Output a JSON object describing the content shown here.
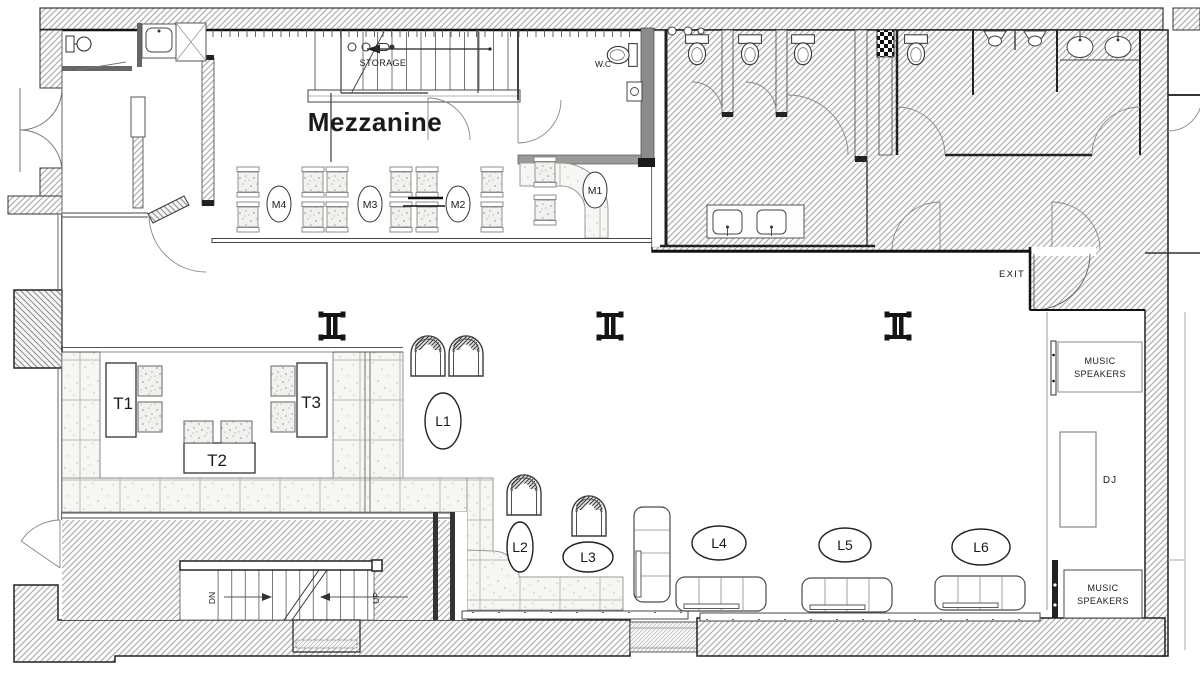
{
  "floorplan": {
    "title": "Mezzanine",
    "rooms": {
      "storage": "STORAGE",
      "wc": "W.C",
      "exit": "EXIT",
      "dj": "DJ"
    },
    "speakers": {
      "top": {
        "line1": "MUSIC",
        "line2": "SPEAKERS"
      },
      "bottom": {
        "line1": "MUSIC",
        "line2": "SPEAKERS"
      }
    },
    "stairs": {
      "down": "DN",
      "up": "UP"
    },
    "mezzanine_tables": [
      {
        "id": "M1"
      },
      {
        "id": "M2"
      },
      {
        "id": "M3"
      },
      {
        "id": "M4"
      }
    ],
    "floor_tables": [
      {
        "id": "T1"
      },
      {
        "id": "T2"
      },
      {
        "id": "T3"
      }
    ],
    "lounge_tables": [
      {
        "id": "L1"
      },
      {
        "id": "L2"
      },
      {
        "id": "L3"
      },
      {
        "id": "L4"
      },
      {
        "id": "L5"
      },
      {
        "id": "L6"
      }
    ]
  }
}
